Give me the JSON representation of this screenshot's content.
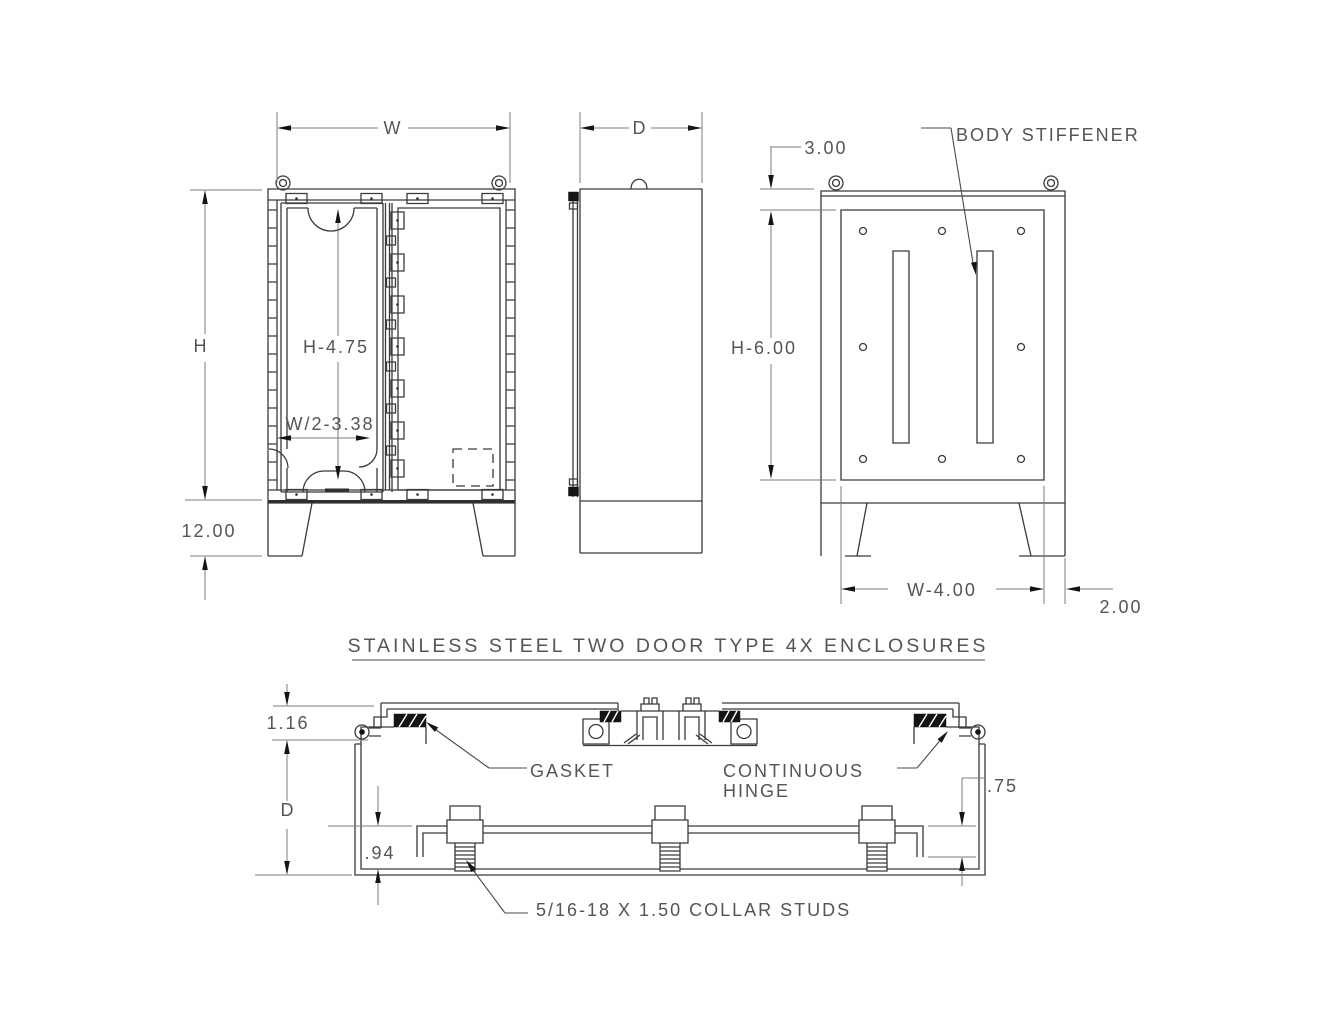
{
  "title": {
    "text": "STAINLESS STEEL TWO DOOR TYPE 4X ENCLOSURES"
  },
  "front_view": {
    "width_label": "W",
    "height_label": "H",
    "panel_height": "H-4.75",
    "panel_width": "W/2-3.38",
    "leg_height": "12.00"
  },
  "side_view": {
    "depth_label": "D"
  },
  "rear_view": {
    "stiffener_callout": "BODY STIFFENER",
    "top_offset": "3.00",
    "cover_height": "H-6.00",
    "leg_spacing": "W-4.00",
    "leg_inset": "2.00"
  },
  "section_view": {
    "flange_depth": "1.16",
    "depth_label": "D",
    "panel_standoff": ".94",
    "panel_clearance": ".75",
    "gasket_callout": "GASKET",
    "hinge_callout_line1": "CONTINUOUS",
    "hinge_callout_line2": "HINGE",
    "stud_callout": "5/16-18 X 1.50 COLLAR STUDS"
  },
  "colors": {
    "geometry": "#3a3a3f",
    "dimension": "#7c7c82",
    "text": "#54545a",
    "fill": "#141414",
    "background": "#ffffff"
  }
}
